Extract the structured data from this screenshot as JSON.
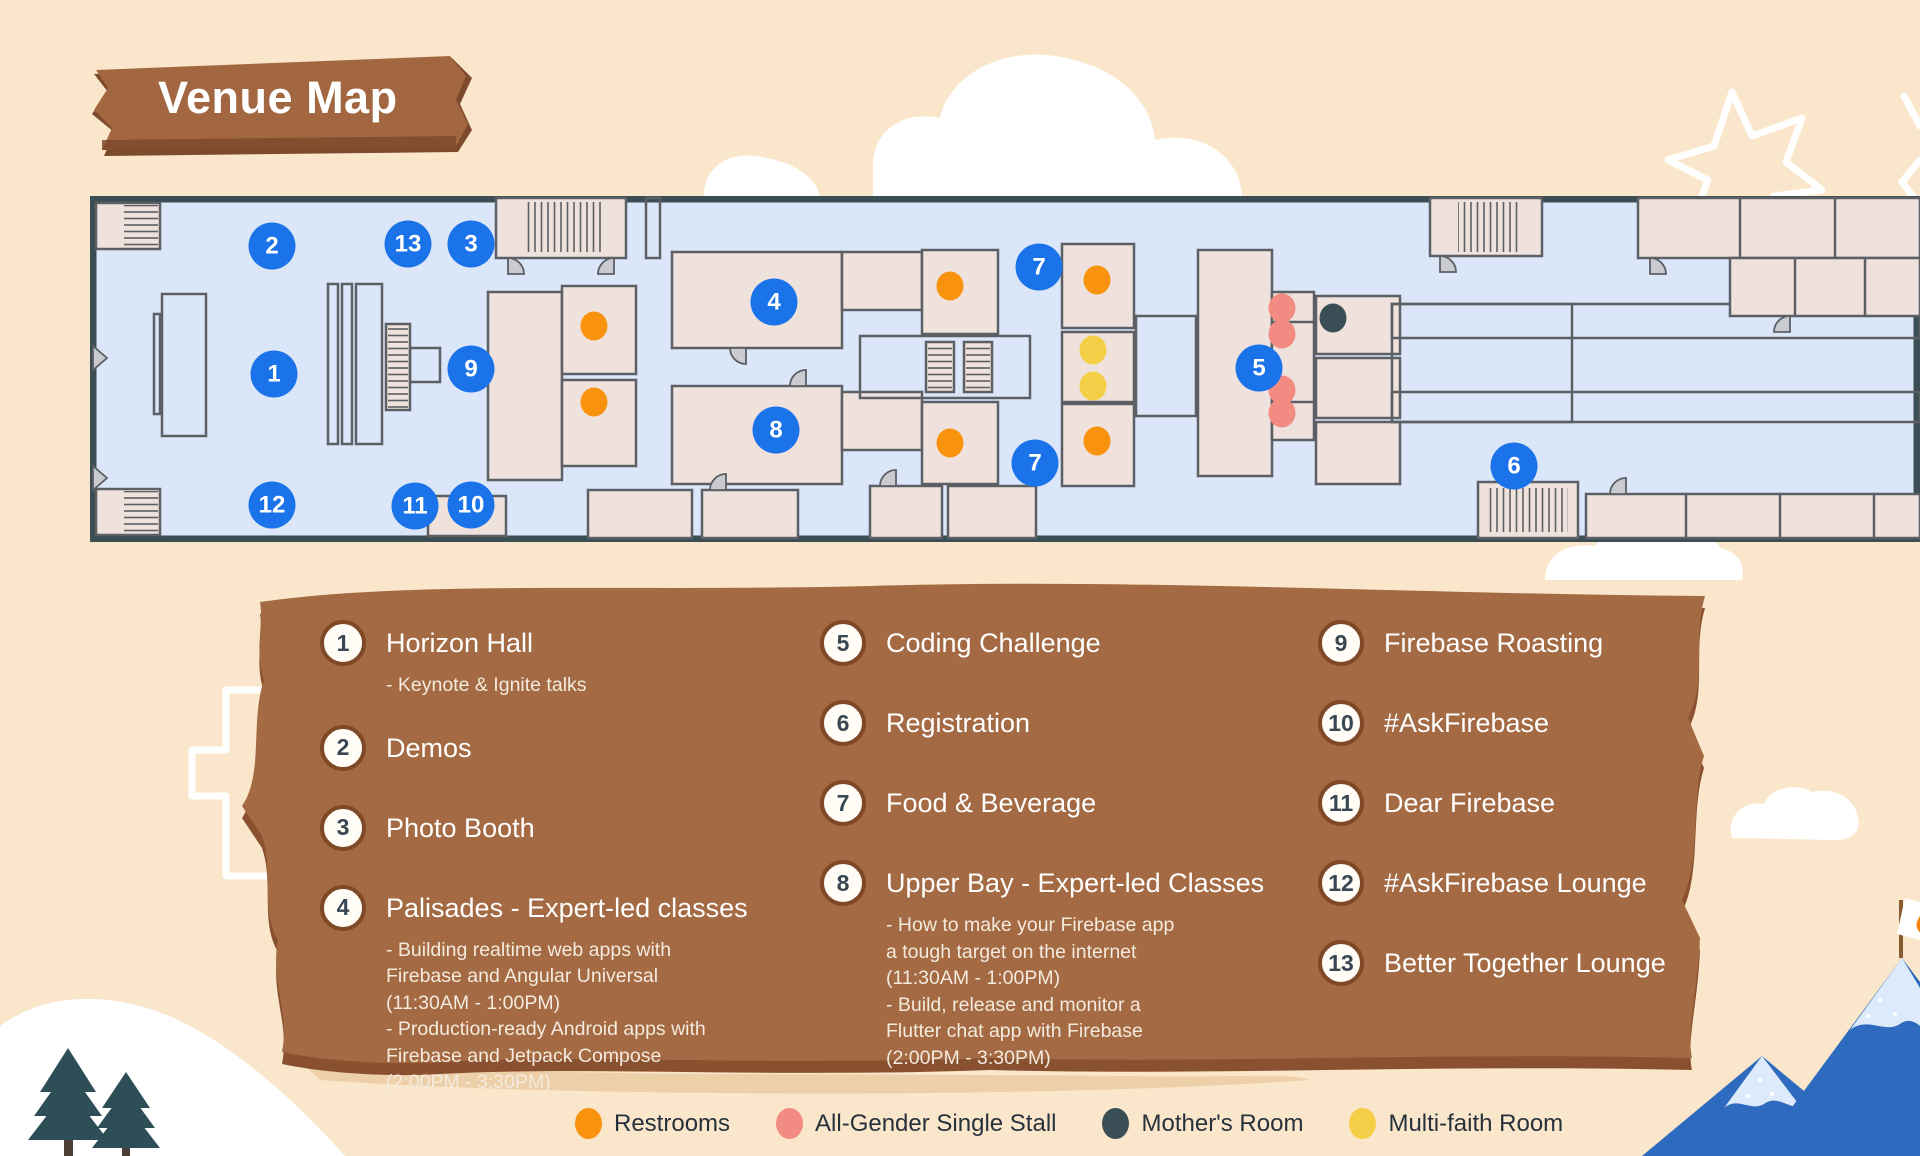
{
  "title": "Venue Map",
  "map": {
    "markers": [
      {
        "n": "1",
        "x": 274,
        "y": 374
      },
      {
        "n": "2",
        "x": 272,
        "y": 246
      },
      {
        "n": "3",
        "x": 471,
        "y": 244
      },
      {
        "n": "13",
        "x": 408,
        "y": 244
      },
      {
        "n": "9",
        "x": 471,
        "y": 369
      },
      {
        "n": "12",
        "x": 272,
        "y": 505
      },
      {
        "n": "11",
        "x": 415,
        "y": 506
      },
      {
        "n": "10",
        "x": 471,
        "y": 505
      },
      {
        "n": "4",
        "x": 774,
        "y": 302
      },
      {
        "n": "8",
        "x": 776,
        "y": 430
      },
      {
        "n": "7",
        "x": 1039,
        "y": 267
      },
      {
        "n": "7",
        "x": 1035,
        "y": 463
      },
      {
        "n": "5",
        "x": 1259,
        "y": 368
      },
      {
        "n": "6",
        "x": 1514,
        "y": 466
      }
    ],
    "dots": [
      {
        "kind": "restroom",
        "x": 594,
        "y": 326
      },
      {
        "kind": "restroom",
        "x": 594,
        "y": 402
      },
      {
        "kind": "restroom",
        "x": 950,
        "y": 286
      },
      {
        "kind": "restroom",
        "x": 950,
        "y": 443
      },
      {
        "kind": "restroom",
        "x": 1097,
        "y": 280
      },
      {
        "kind": "restroom",
        "x": 1097,
        "y": 441
      },
      {
        "kind": "multi-faith",
        "x": 1093,
        "y": 350
      },
      {
        "kind": "multi-faith",
        "x": 1093,
        "y": 386
      },
      {
        "kind": "all-gender",
        "x": 1282,
        "y": 308
      },
      {
        "kind": "all-gender",
        "x": 1282,
        "y": 334
      },
      {
        "kind": "all-gender",
        "x": 1282,
        "y": 390
      },
      {
        "kind": "all-gender",
        "x": 1282,
        "y": 413
      },
      {
        "kind": "mothers-room",
        "x": 1333,
        "y": 318
      }
    ]
  },
  "legend_columns": [
    [
      {
        "num": "1",
        "label": "Horizon Hall",
        "sub_lines": [
          "-   Keynote & Ignite talks"
        ]
      },
      {
        "num": "2",
        "label": "Demos",
        "sub_lines": []
      },
      {
        "num": "3",
        "label": "Photo Booth",
        "sub_lines": []
      },
      {
        "num": "4",
        "label": "Palisades - Expert-led classes",
        "sub_lines": [
          "-   Building realtime web apps with",
          "Firebase and Angular Universal",
          "(11:30AM - 1:00PM)",
          "-   Production-ready Android apps with",
          "Firebase and Jetpack Compose",
          "(2:00PM - 3:30PM)"
        ]
      }
    ],
    [
      {
        "num": "5",
        "label": "Coding Challenge",
        "sub_lines": []
      },
      {
        "num": "6",
        "label": "Registration",
        "sub_lines": []
      },
      {
        "num": "7",
        "label": "Food & Beverage",
        "sub_lines": []
      },
      {
        "num": "8",
        "label": "Upper Bay - Expert-led Classes",
        "sub_lines": [
          "-   How to make your Firebase app",
          "a tough target on the internet",
          "(11:30AM - 1:00PM)",
          "-   Build, release and monitor a",
          "Flutter chat app with Firebase",
          "(2:00PM - 3:30PM)"
        ]
      }
    ],
    [
      {
        "num": "9",
        "label": "Firebase Roasting",
        "sub_lines": []
      },
      {
        "num": "10",
        "label": "#AskFirebase",
        "sub_lines": []
      },
      {
        "num": "11",
        "label": "Dear Firebase",
        "sub_lines": []
      },
      {
        "num": "12",
        "label": "#AskFirebase Lounge",
        "sub_lines": []
      },
      {
        "num": "13",
        "label": "Better Together Lounge",
        "sub_lines": []
      }
    ]
  ],
  "amenity_key": [
    {
      "kind": "restroom",
      "label": "Restrooms",
      "color": "#F9930E"
    },
    {
      "kind": "all-gender",
      "label": "All-Gender Single Stall",
      "color": "#F28B82"
    },
    {
      "kind": "mothers-room",
      "label": "Mother's Room",
      "color": "#3A4E55"
    },
    {
      "kind": "multi-faith",
      "label": "Multi-faith Room",
      "color": "#F5CE47"
    }
  ],
  "colors": {
    "marker_blue": "#1A73E8",
    "panel_brown": "#A36A43",
    "background": "#FAE7CB"
  }
}
